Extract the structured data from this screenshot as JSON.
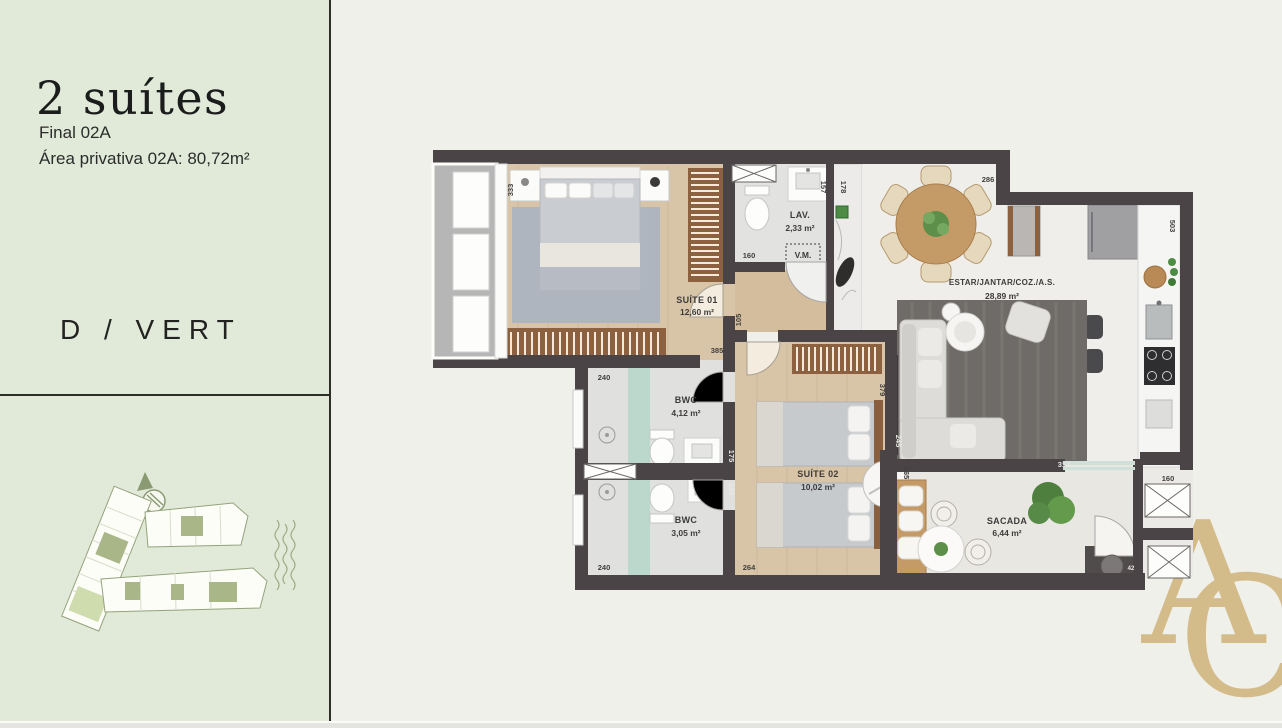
{
  "sidebar": {
    "title": "2 suítes",
    "final_label": "Final 02A",
    "area_label": "Área privativa 02A: 80,72m²",
    "variant_label": "D / VERT"
  },
  "logo": {
    "letter_a": "A",
    "letter_c": "C"
  },
  "floorplan": {
    "rooms": {
      "suite1_name": "SUÍTE 01",
      "suite1_area": "12,60 m²",
      "lav_name": "LAV.",
      "lav_area": "2,33 m²",
      "vm_label": "V.M.",
      "estar_name": "ESTAR/JANTAR/COZ./A.S.",
      "estar_area": "28,89 m²",
      "bwc1_name": "BWC",
      "bwc1_area": "4,12 m²",
      "bwc2_name": "BWC",
      "bwc2_area": "3,05 m²",
      "suite2_name": "SUÍTE 02",
      "suite2_area": "10,02 m²",
      "sacada_name": "SACADA",
      "sacada_area": "6,44 m²"
    },
    "dims": {
      "suite1_width": "333",
      "lav_side": "157",
      "as_side": "178",
      "estar_top": "286",
      "kitchen_right": "503",
      "lav_width": "160",
      "hall_height": "105",
      "suite1_bottom": "385",
      "bwc1_window": "240",
      "bwc1_wall": "175",
      "bwc2_wall": "130",
      "bwc2_window": "240",
      "suite2_bottom": "264",
      "suite2_wall": "379",
      "suite2_side": "245",
      "sacada_bench": "165",
      "estar_bottom": "317",
      "shaft": "160",
      "entry": "42"
    }
  },
  "colors": {
    "sidebar_bg": "#e1ead9",
    "main_bg": "#f0f0ea",
    "wall": "#4a4446",
    "wood_floor": "#d8c5a8",
    "accent_gold": "#d4bc8a",
    "site_green": "#a9b687",
    "shower_glass": "#bcd8cd"
  }
}
